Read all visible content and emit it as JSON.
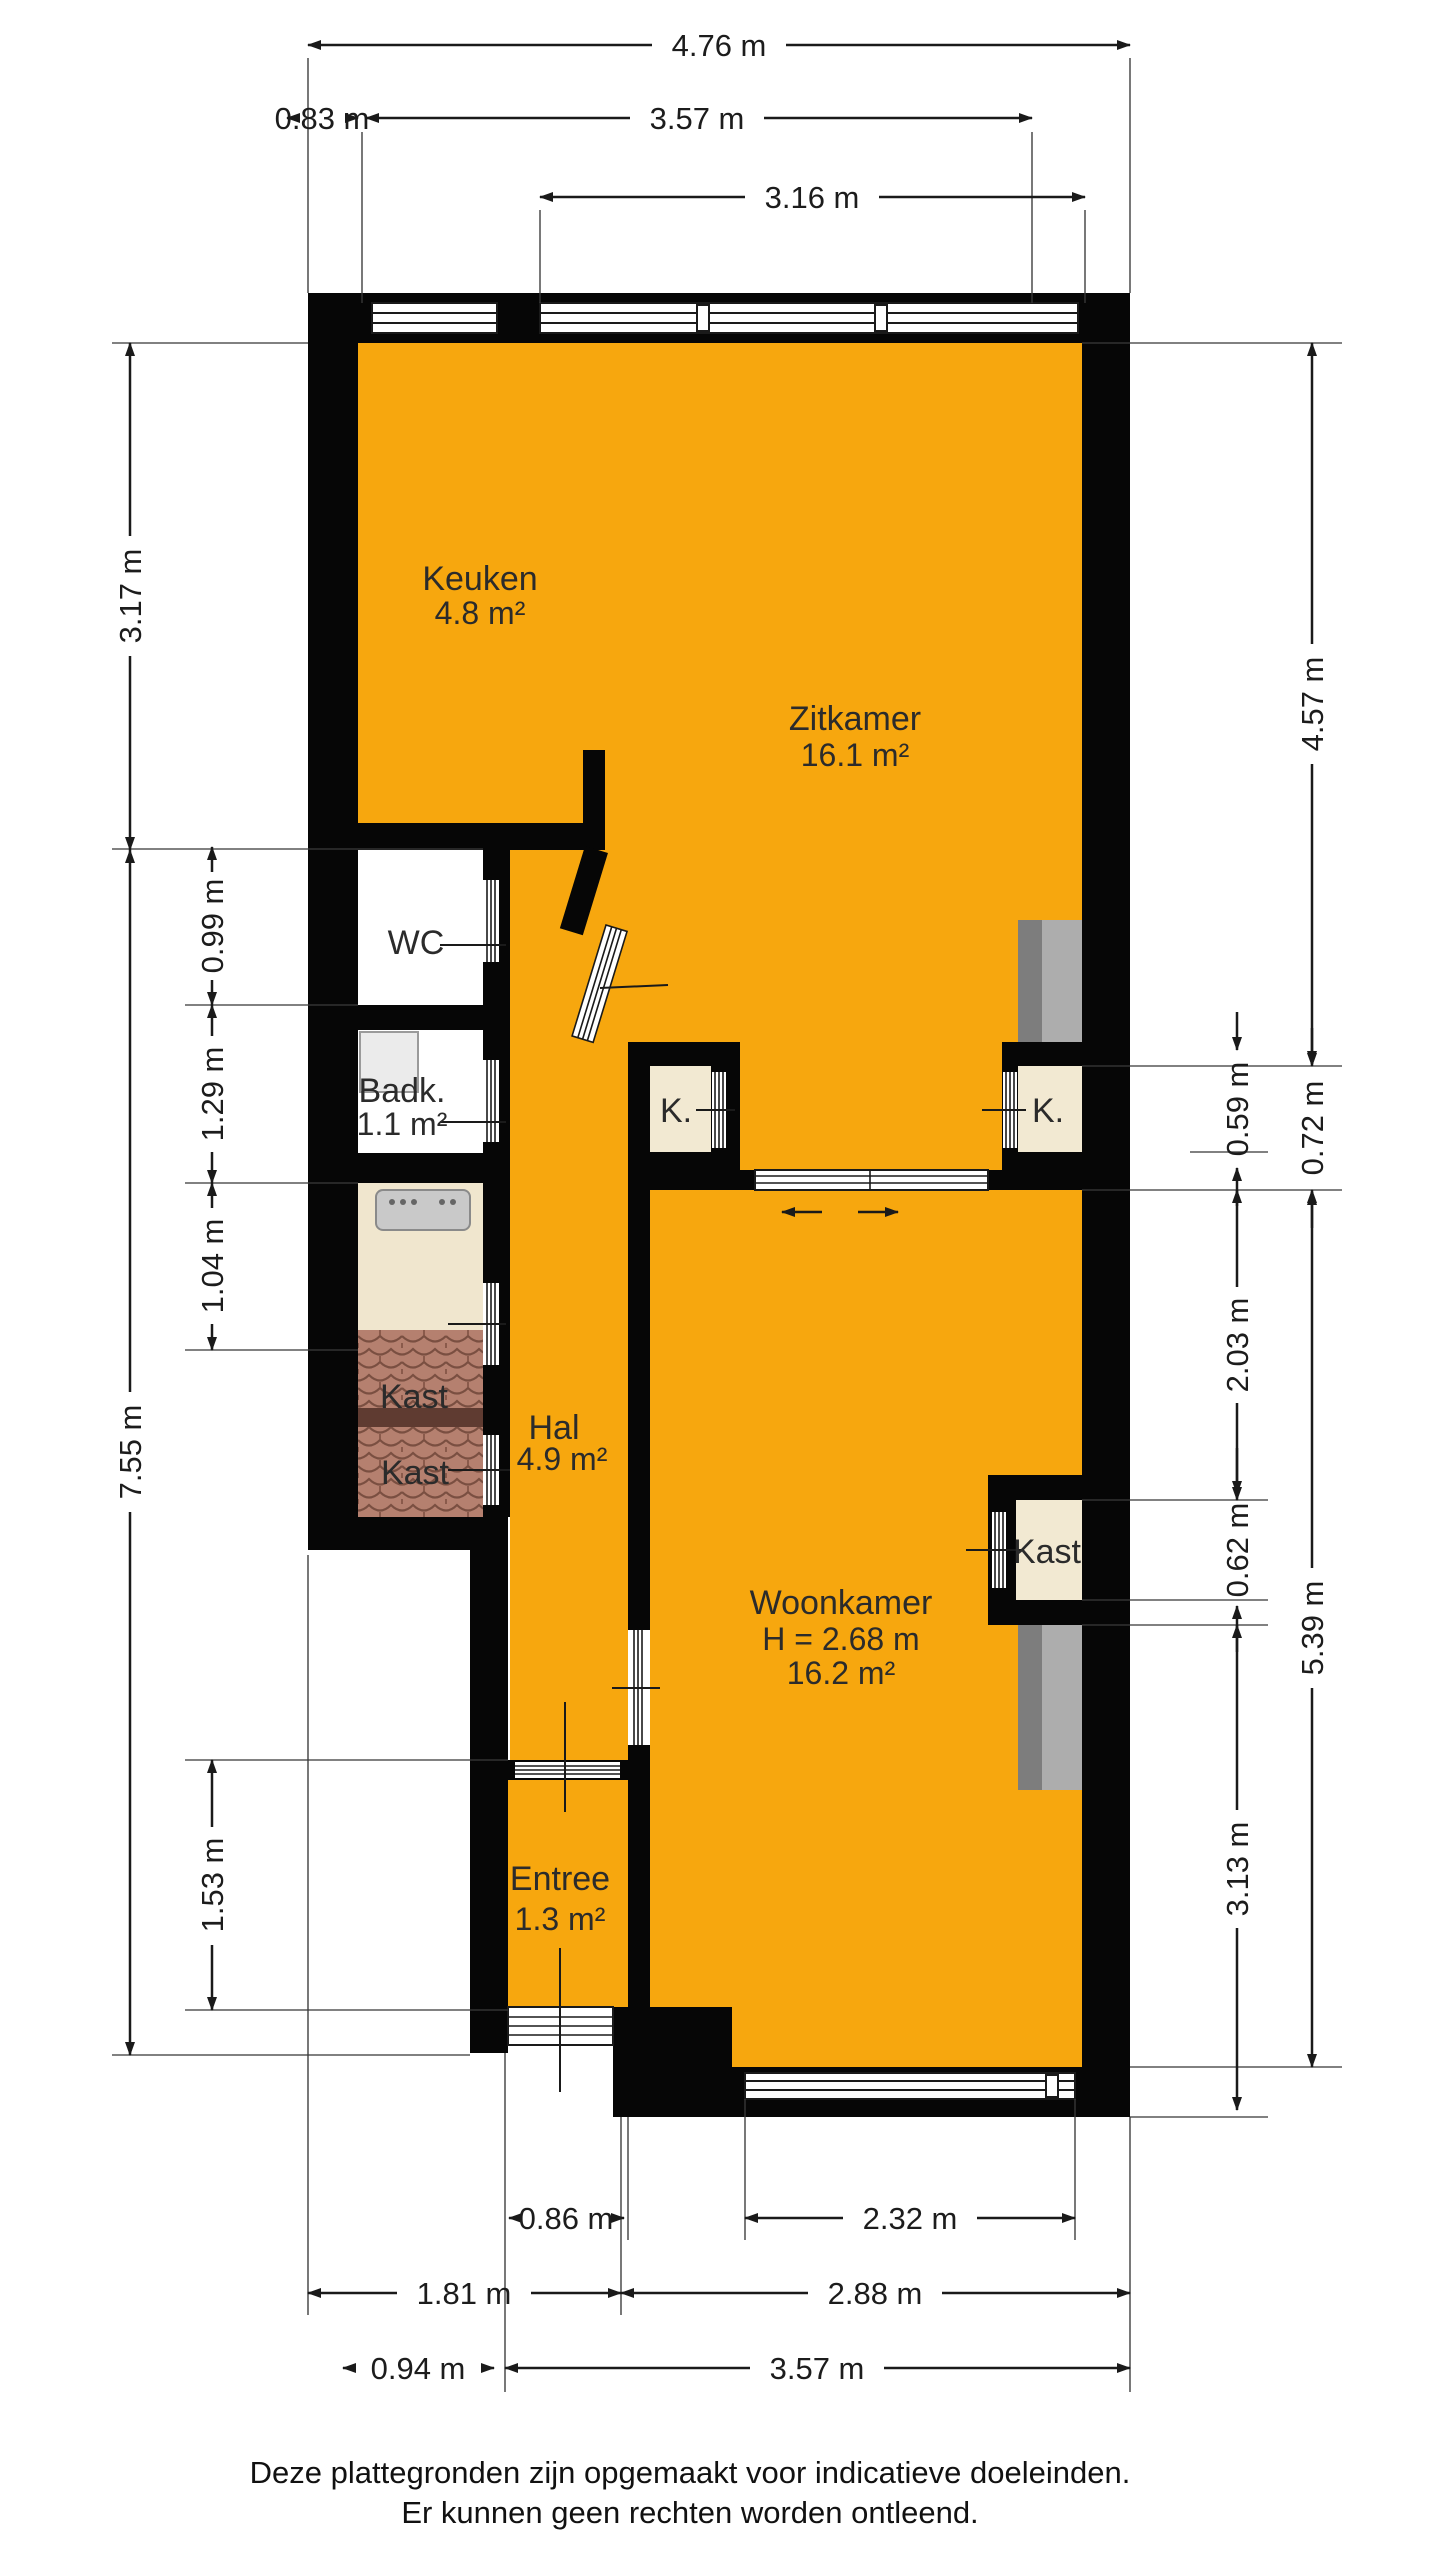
{
  "plan_title": "floorplan",
  "rooms": {
    "keuken": {
      "name": "Keuken",
      "area": "4.8 m²"
    },
    "zitkamer": {
      "name": "Zitkamer",
      "area": "16.1 m²"
    },
    "wc": {
      "name": "WC"
    },
    "badkamer": {
      "name": "Badk.",
      "area": "1.1 m²"
    },
    "kast_links_boven": {
      "name": "Kast"
    },
    "kast_links_onder": {
      "name": "Kast"
    },
    "hal": {
      "name": "Hal",
      "area": "4.9 m²"
    },
    "woonkamer": {
      "name": "Woonkamer",
      "height": "H = 2.68 m",
      "area": "16.2 m²"
    },
    "kast_rechts": {
      "name": "Kast"
    },
    "entree": {
      "name": "Entree",
      "area": "1.3 m²"
    },
    "k_links": {
      "name": "K."
    },
    "k_rechts": {
      "name": "K."
    }
  },
  "dimensions": {
    "top": [
      "4.76 m",
      "0.83 m",
      "3.57 m",
      "3.16 m"
    ],
    "left_outer": [
      "3.17 m",
      "7.55 m"
    ],
    "left_inner": [
      "0.99 m",
      "1.29 m",
      "1.04 m",
      "1.53 m"
    ],
    "right_inner": [
      "0.59 m",
      "2.03 m",
      "0.62 m",
      "3.13 m"
    ],
    "right_outer": [
      "4.57 m",
      "0.72 m",
      "5.39 m"
    ],
    "bottom": [
      "0.86 m",
      "2.32 m",
      "1.81 m",
      "2.88 m",
      "0.94 m",
      "3.57 m"
    ]
  },
  "footer": {
    "line1": "Deze plattegronden zijn opgemaakt voor indicatieve doeleinden.",
    "line2": "Er kunnen geen rechten worden ontleend."
  },
  "colors": {
    "floor": "#F7A70E",
    "wall": "#060606",
    "closet_floor": "#F2E9D2",
    "tiles": "#B5806F",
    "chimney_dark": "#7D7D7D",
    "chimney_light": "#ADADAD"
  }
}
